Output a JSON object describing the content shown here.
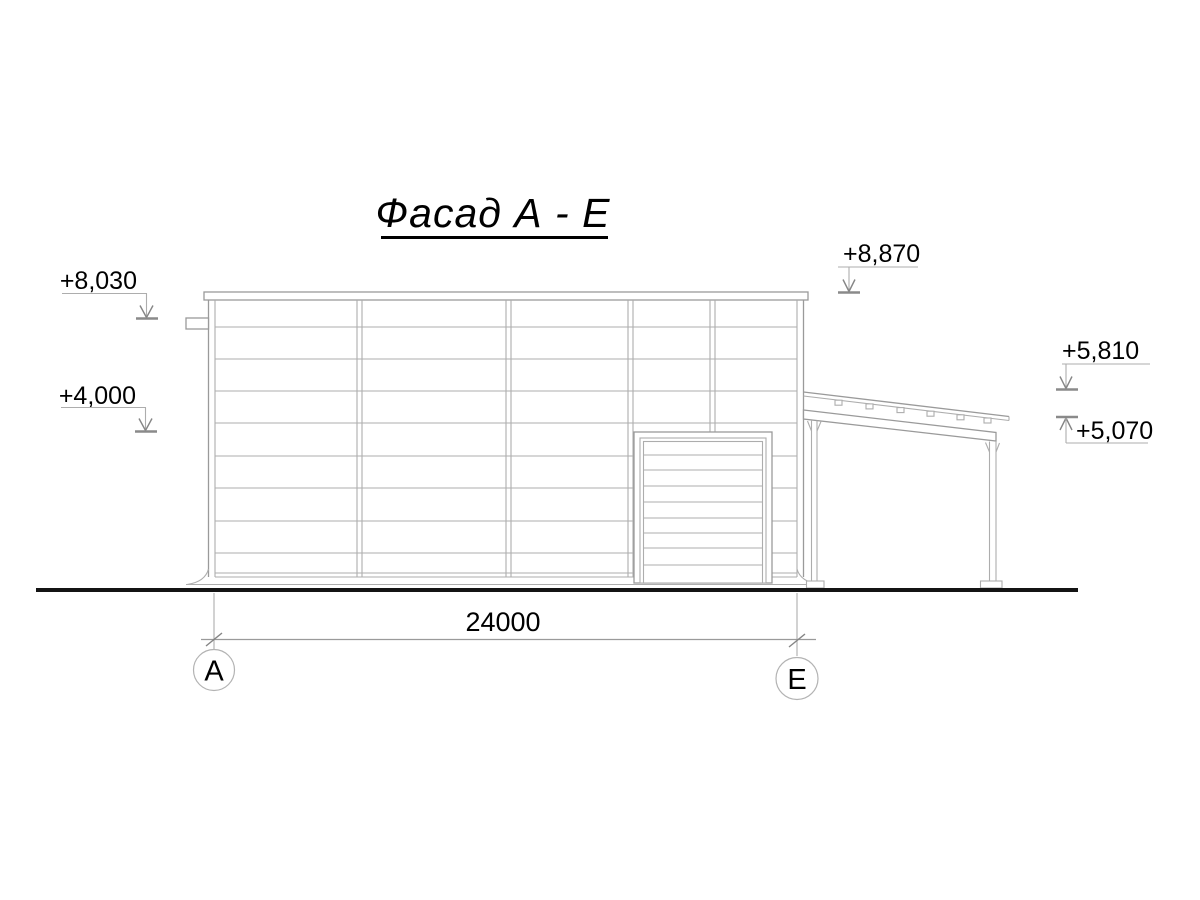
{
  "drawing": {
    "title": "Фасад А - Е"
  },
  "elevation_marks": [
    {
      "id": "parapet-left",
      "label": "+8,030"
    },
    {
      "id": "mid-left",
      "label": "+4,000"
    },
    {
      "id": "parapet-right",
      "label": "+8,870"
    },
    {
      "id": "annex-roof-high",
      "label": "+5,810"
    },
    {
      "id": "annex-roof-low",
      "label": "+5,070"
    }
  ],
  "dimension": {
    "label": "24000"
  },
  "axes": [
    {
      "label": "А"
    },
    {
      "label": "Е"
    }
  ],
  "colors": {
    "line": "#adadad",
    "line_dark": "#8a8a8a",
    "text": "#000000",
    "ground": "#141414",
    "background": "#ffffff"
  }
}
